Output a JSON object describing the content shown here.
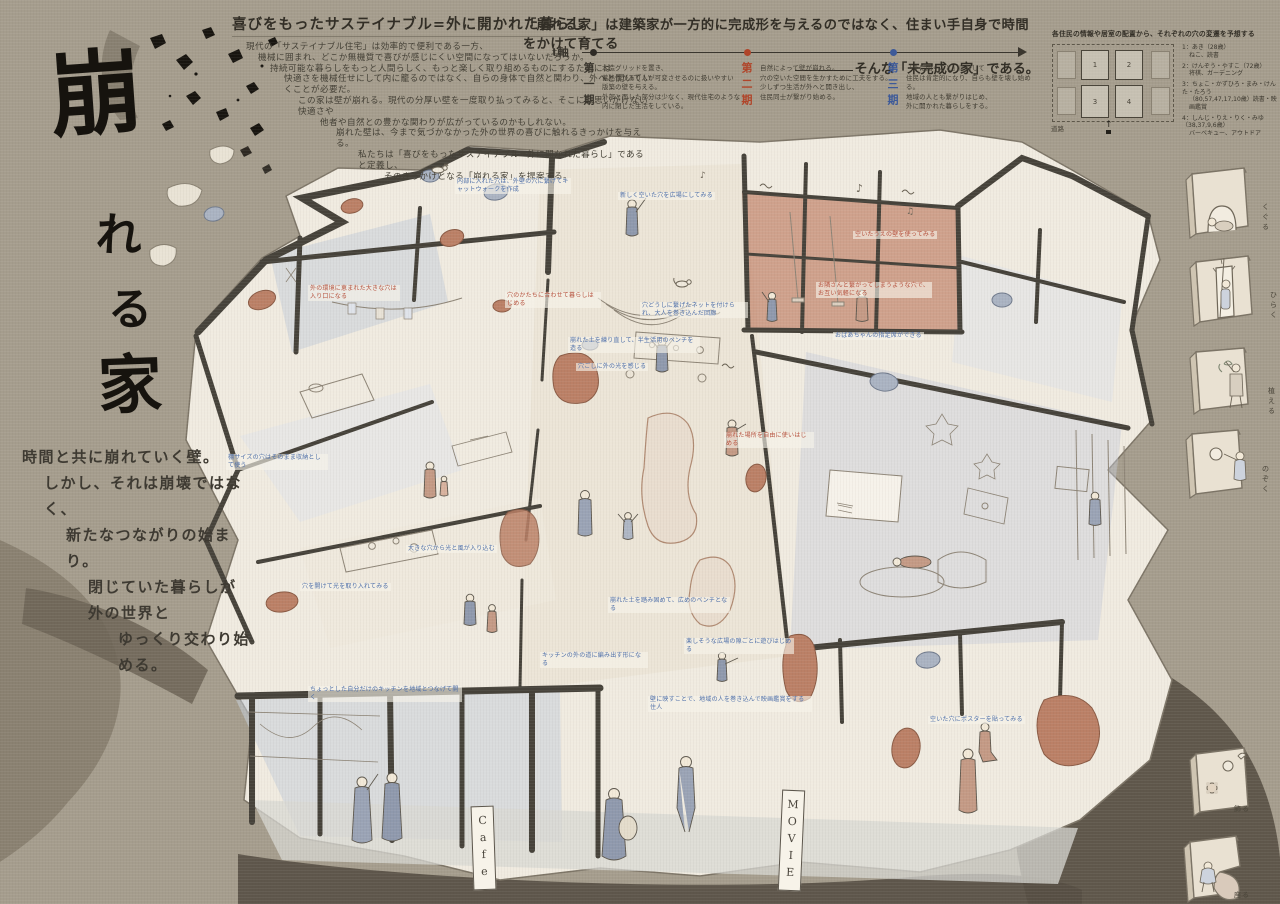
{
  "colors": {
    "background_taupe": "#a59d8d",
    "paper_cream": "#f0ebe0",
    "wall_ink": "#46423a",
    "accent_red": "#b0452a",
    "accent_blue": "#3d5a99",
    "annotation_blue": "#4d6ea8",
    "annotation_red": "#b5503c",
    "terracotta": "#c2846b",
    "blue_grey_wash": "#c7cdd9",
    "title_ink": "#16130e"
  },
  "title": {
    "text": "崩れる家",
    "chars": [
      "崩",
      "れ",
      "る",
      "家"
    ]
  },
  "intro": {
    "heading": "喜びをもったサステイナブル=外に開かれた暮らし",
    "lines": [
      "現代の「サステイナブル住宅」は効率的で便利である一方、",
      "機械に囲まれ、どこか無機質で喜びが感じにくい空間になってはいないだろうか。",
      "持続可能な暮らしをもっと人間らしく、もっと楽しく取り組めるものにするためには",
      "快適さを機械任せにして内に籠るのではなく、自らの身体で自然と関わり、外へと開いていくことが必要だ。",
      "この家は壁が崩れる。現代の分厚い壁を一度取り払ってみると、そこには思いがけない快適さや",
      "他者や自然との豊かな関わりが広がっているのかもしれない。",
      "崩れた壁は、今まで気づかなかった外の世界の喜びに触れるきっかけを与える。",
      "私たちは「喜びをもったサステイナブル=外に開かれた暮らし」であると定義し、",
      "そのきっかけとなる「崩れる家」を提案する。"
    ]
  },
  "concept": {
    "line1": "「崩れる家」は建築家が一方的に完成形を与えるのではなく、住まい手自身で時間をかけて育てる",
    "line2": "そんな「未完成の家」である。"
  },
  "timeline": {
    "axis_label": "t軸",
    "periods": [
      {
        "label": "第一期",
        "lines": [
          "木造グリッドを置き、",
          "蓄熱性があり人が可変させるのに扱いやすい",
          "版築の壁を与える。",
          "外部と面した部分は少なく、現代住宅のような",
          "内に閉じた生活をしている。"
        ]
      },
      {
        "label": "第二期",
        "lines": [
          "自然によって壁が崩れる。",
          "穴の空いた空間を生かすために工夫をする。",
          "少しずつ生活が外へと開き出し、",
          "住民同士が繋がり始める。"
        ]
      },
      {
        "label": "第三期",
        "lines": [
          "「外に開くこと」に対して",
          "住民は肯定的になり、自らも壁を壊し始める。",
          "地域の人とも繋がりはじめ、",
          "外に開かれた暮らしをする。"
        ]
      }
    ]
  },
  "legend": {
    "title": "各住民の情報や居室の配置から、それぞれの穴の変遷を予想する",
    "road_label": "道路",
    "cells": [
      "1",
      "2",
      "3",
      "4"
    ],
    "residents": [
      {
        "name": "1：あき（28歳）",
        "hobby": "ねこ、読書"
      },
      {
        "name": "2：けんぞう・やすこ（72歳）",
        "hobby": "将棋、ガーデニング"
      },
      {
        "name": "3：ちょこ・かずひろ・まみ・けんた・たろう",
        "hobby": "（80,57,47,17,10歳）読書・映画鑑賞"
      },
      {
        "name": "4：しんじ・りえ・りく・みゆ（38,37,9,6歳）",
        "hobby": "バーベキュー、アウトドア"
      }
    ]
  },
  "poem": {
    "lines": [
      "時間と共に崩れていく壁。",
      "しかし、それは崩壊ではなく、",
      "新たなつながりの始まり。",
      "閉じていた暮らしが外の世界と",
      "ゆっくり交わり始める。"
    ]
  },
  "vignettes": [
    {
      "label": "くぐる"
    },
    {
      "label": "ひらく"
    },
    {
      "label": "植える"
    },
    {
      "label": "のぞく"
    },
    {
      "label": "飾る"
    },
    {
      "label": "座る"
    }
  ],
  "annotations": [
    {
      "text": "内部に入れた穴は、外壁の穴に繋げてキャットウォークを作成"
    },
    {
      "text": "新しく空いた穴を広場にしてみる"
    },
    {
      "text": "穴のかたちに合わせて暮らしはじめる"
    },
    {
      "text": "穴どうしに繋げたネットを付けられ、大人を巻き込んだ回廊"
    },
    {
      "text": "崩れた土を練り直して、半生活用のベンチを造る"
    },
    {
      "text": "穴ごしに外の光を感じる"
    },
    {
      "text": "空いたうえの壁を使ってみる"
    },
    {
      "text": "お隣さんと繋がってしまうような穴で、お互い気軽になる"
    },
    {
      "text": "おばあちゃんの指定席ができる"
    },
    {
      "text": "外の環境に恵まれた大きな穴は入り口になる"
    },
    {
      "text": "棚サイズの穴はそのまま収納として使う"
    },
    {
      "text": "穴を開けて光を取り入れてみる"
    },
    {
      "text": "ちょっとした自分だけのキッチンを地域とつなげて開く"
    },
    {
      "text": "崩れた土を踏み固めて、広めのベンチとなる"
    },
    {
      "text": "キッチンの外の道に編み出す形になる"
    },
    {
      "text": "楽しそうな広場の隙ごとに遊びはじめる"
    },
    {
      "text": "壁に映すことで、地域の人を巻き込んで映画鑑賞をする住人"
    },
    {
      "text": "空いた穴にポスターを貼ってみる"
    },
    {
      "text": "崩れた場所を自由に使いはじめる"
    },
    {
      "text": "大きな穴から光と風が入り込む"
    }
  ],
  "signs": {
    "cafe": "Cafe",
    "movie": "MOVIE"
  }
}
